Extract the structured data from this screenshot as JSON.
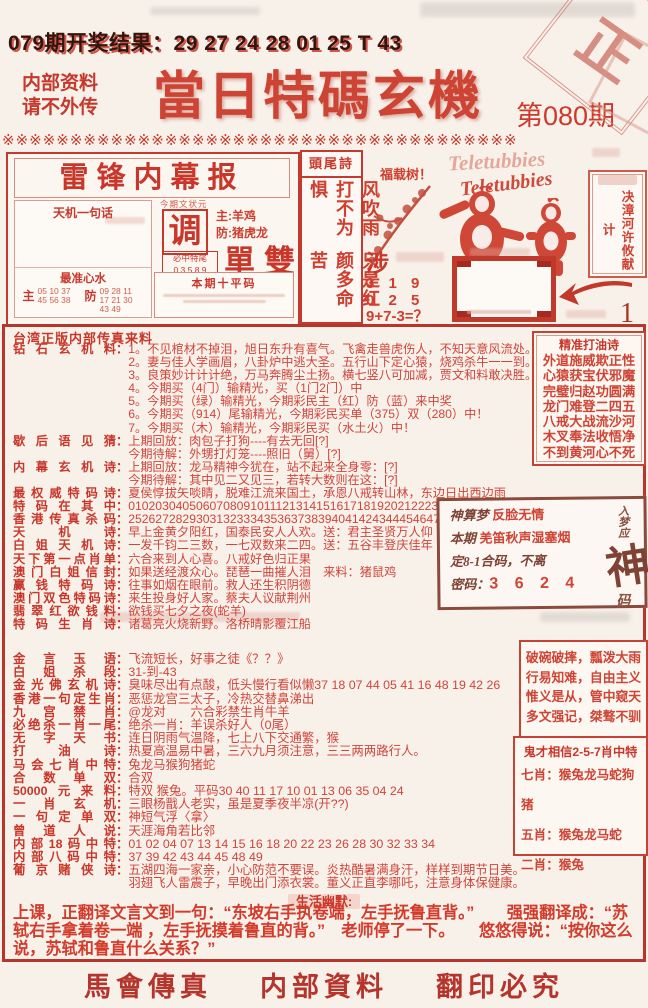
{
  "misc": {
    "colon": "："
  },
  "page": {
    "result_line": "079期开奖结果：29 27 24 28 01 25 T 43",
    "confidential": [
      "内部资料",
      "请不外传"
    ],
    "title": "當日特碼玄機",
    "issue": "第080期",
    "separator": "※※※※※※※※※※※※※※※※※※※※※※※※※※※※※※※※※※※※※※",
    "stamp": "正",
    "accent_color": "#cf4434"
  },
  "leifeng_box": {
    "title": "雷锋内幕报",
    "tianji_label": "天机一句话",
    "zuixin_label": "最准心水",
    "zhu_small_label": "主",
    "zhu_small": "05 10 37 45 56 38",
    "fang_small_label": "防",
    "fang_small": "09 28 11 17 21 30 43 49",
    "one_char_header": "今期文状元",
    "one_char": "调",
    "zhu_line": "主:羊鸡",
    "fang_line": "防:猪虎龙",
    "danshuang": "單雙",
    "bizhong_label": "必中特尾",
    "bizhong_digits": "0 3 5 8 9",
    "pingma_label": "本期十平码"
  },
  "touwei": {
    "header": "頭尾詩",
    "col_right": "风吹雨打不为惧",
    "col_left": "只是红颜多命苦"
  },
  "cartoon": {
    "tree": "福载树！",
    "brand": "Teletubbies",
    "she": "涉",
    "numbers": [
      "3 1 9",
      "0 2 5",
      "9+7-3=？"
    ],
    "side_box": "决漳河许攸献计",
    "mark": "1"
  },
  "upper": {
    "header": "台湾正版内部传真来料",
    "rows": [
      {
        "label": "钻石玄机料",
        "lines": [
          "1。不见棺材不掉泪，旭日东升有喜气。飞禽走兽虎伤人，不知天意风流处。（俱）",
          "2。妻与佳人学画眉，八卦炉中逃大圣。五行山下定心猿，烧鸡杀牛一一到。（猪）",
          "3。良策妙计计计绝，万马奔腾尘土扬。横七竖八可加减，贾文和料敢决胜。（蛇）",
          "4。今期买（4门）输精光，买（1门2门）中",
          "5。今期买（绿）输精光，今期彩民主（红）防（蓝）来中奖",
          "6。今期买（914）尾输精光，今期彩民买单（375）双（280）中！",
          "7。今期买（木）输精光，今期彩民买（水土火）中！"
        ]
      },
      {
        "label": "歇后语见猜",
        "lines": [
          "上期回放：肉包子打狗----有去无回[?]",
          "今期待解：外甥打灯笼----照旧（舅）[?]"
        ]
      },
      {
        "label": "内幕玄机诗",
        "lines": [
          "上期回放：龙马精神今犹在，站不起来全身零：[?]",
          "今期待解：其中见二又见三，若转大数则在这：[?]"
        ]
      },
      {
        "label": "最权威特码诗",
        "lines": [
          "夏侯惇拔矢啖睛，脱难江流来国土，承恩八戒转山林，东边日出西边雨"
        ]
      },
      {
        "label": "特码在其中",
        "lines": [
          "010203040506070809101112131415161718192021222324"
        ]
      },
      {
        "label": "香港传真杀码",
        "lines": [
          "25262728293031323334353637383940414243444546474849"
        ]
      },
      {
        "label": "天机诗",
        "lines": [
          "早上金黄夕阳红，国泰民安人人欢。送：君主圣贤万人仰"
        ]
      },
      {
        "label": "白姐天机诗",
        "lines": [
          "一发千钧二三数，一七双数来二四。送：五谷丰登庆佳年"
        ]
      },
      {
        "label": "天下第一点肖单",
        "lines": [
          "六合来到人心喜。八戒好色归正果"
        ]
      },
      {
        "label": "澳门白姐信封",
        "lines": [
          "如果送经渡众心。琵琶一曲摧人泪　来料：猪鼠鸡"
        ]
      },
      {
        "label": "赢钱特码诗",
        "lines": [
          "往事如烟在眼前。救人还生积阴德"
        ]
      },
      {
        "label": "澳门双色特码诗",
        "lines": [
          "来生投身好人家。蔡夫人议献荆州"
        ]
      },
      {
        "label": "翡翠红欲钱料",
        "lines": [
          "欲钱买七夕之夜(蛇羊)"
        ]
      },
      {
        "label": "特码生肖诗",
        "lines": [
          "诸葛亮火烧新野。洛桥晴影覆江船"
        ]
      }
    ]
  },
  "poem_box": {
    "title": "精准打油诗",
    "lines": [
      "外道施威欺正性",
      "心猿获宝伏邪魔",
      "完璧归赵功圆满",
      "龙门难登二四五",
      "八戒大战流沙河",
      "木叉奉法收悟净",
      "不到黄河心不死"
    ]
  },
  "dream_box": {
    "l1_label": "神算梦",
    "l1": "反脸无情",
    "l2_label": "本期",
    "l2": "羌笛秋声湿塞烟",
    "l3": "定8-1合码，不离",
    "l4_label": "密码：",
    "l4": "3 6 2 4",
    "side_top": "入梦应",
    "side_big": "神",
    "side_bottom": "码"
  },
  "lower": {
    "rows": [
      {
        "label": "金言玉语",
        "lines": [
          "飞流短长，好事之徒《？？》"
        ]
      },
      {
        "label": "白姐杀段",
        "lines": [
          "31-到-43"
        ]
      },
      {
        "label": "金光佛玄机诗",
        "lines": [
          "臭味尽出有点酸，低头慢行看似懒37 18 07 44 05 41 16 48 19 42 26"
        ]
      },
      {
        "label": "香港一句定生肖",
        "lines": [
          "恶惩龙宫三太子，冷热交替鼻涕出"
        ]
      },
      {
        "label": "九宫禁肖",
        "lines": [
          "@龙对　　六合彩禁生肖牛羊"
        ]
      },
      {
        "label": "必绝杀一肖一尾",
        "lines": [
          "绝杀一肖：羊误杀好人（0尾）"
        ]
      },
      {
        "label": "无字天书",
        "lines": [
          "连日阴雨气温降，七上八下交通繁，猴"
        ]
      },
      {
        "label": "打油诗",
        "lines": [
          "热夏高温易中暑，三六九月须注意，三三两两路行人。"
        ]
      },
      {
        "label": "马会七肖中特",
        "lines": [
          "兔龙马猴狗猪蛇"
        ]
      },
      {
        "label": "合数单双",
        "lines": [
          "合双"
        ]
      },
      {
        "label": "50000元来料",
        "lines": [
          "特双 猴兔。平码30 40 11 17 10 01 13 06 35 04 24"
        ]
      },
      {
        "label": "一肖玄机",
        "lines": [
          "三眼杨戬人老实，虽是夏季夜半凉(开??)"
        ]
      },
      {
        "label": "一句定单双",
        "lines": [
          "神短气浮〈拿〉"
        ]
      },
      {
        "label": "曾道人说",
        "lines": [
          "天涯海角若比邻"
        ]
      },
      {
        "label": "内部18码中特",
        "lines": [
          "01 02 04 07 13 14 15 16 18 20 22 23 26 28 30 32 33 34"
        ]
      },
      {
        "label": "内部八码中特",
        "lines": [
          "37 39 42 43 44 45 48 49"
        ]
      },
      {
        "label": "葡京赌侠诗",
        "lines": [
          "五湖四海一家亲，小心防范不要误。炎热酷暑满身汗，样样到期节日美。",
          "羽翅飞人雷震子，早晚出门添衣裳。董义正直李哪吒，注意身体保健康。"
        ]
      }
    ]
  },
  "right_box1": {
    "lines": [
      "破碗破摔，瓢泼大雨",
      "行易知难，自由主义",
      "惟义是从，管中窥天",
      "多文强记，桀骜不驯"
    ]
  },
  "right_box2": {
    "title": "鬼才相信2-5-7肖中特",
    "lines": [
      "七肖：猴兔龙马蛇狗猪",
      "五肖：猴兔龙马蛇",
      "二肖：猴兔"
    ]
  },
  "humor": {
    "label": "生活幽默:",
    "text": "上课，正翻译文言文到一句：“东坡右手执卷端，左手抚鲁直背。”　　强强翻译成：“苏轼右手拿着卷一端 ，左手抚摸着鲁直的背。”　老师停了一下。　　悠悠得说：“按你这么说，苏轼和鲁直什么关系？”"
  },
  "footer": {
    "items": [
      "馬會傳真",
      "内部資料",
      "翻印必究"
    ]
  }
}
